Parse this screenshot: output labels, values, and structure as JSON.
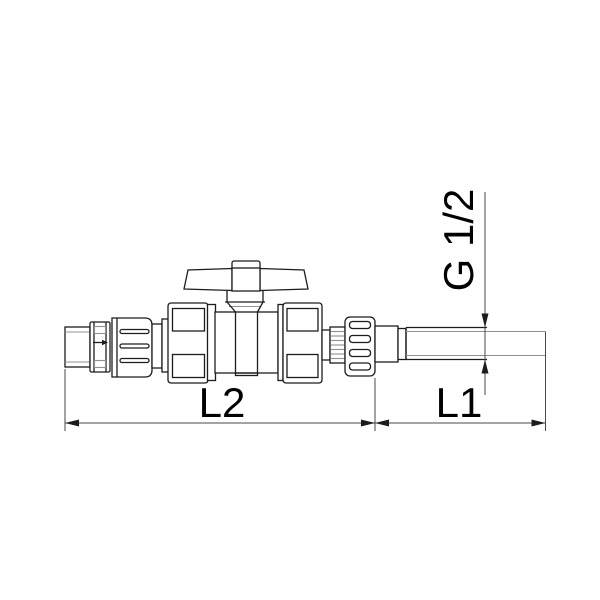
{
  "diagram": {
    "type": "technical-drawing",
    "subject": "ball-valve-with-union-ends-and-threaded-pipe-spigot",
    "dimensions": {
      "l2_label": "L2",
      "l1_label": "L1",
      "thread_label": "G 1/2"
    },
    "colors": {
      "background": "#ffffff",
      "outline": "#1c1c1c",
      "secondary_line": "#909090",
      "dimension_line": "#4a4a4a",
      "label_text": "#000000"
    },
    "parts": [
      "male-threaded-adapter",
      "ribbed-collar",
      "compression-nut-left",
      "union-nut-left",
      "ball-valve-body",
      "butterfly-handle",
      "union-nut-right",
      "splined-insert",
      "knurled-nut-right",
      "barb-cylinder",
      "threaded-pipe-spigot"
    ]
  }
}
